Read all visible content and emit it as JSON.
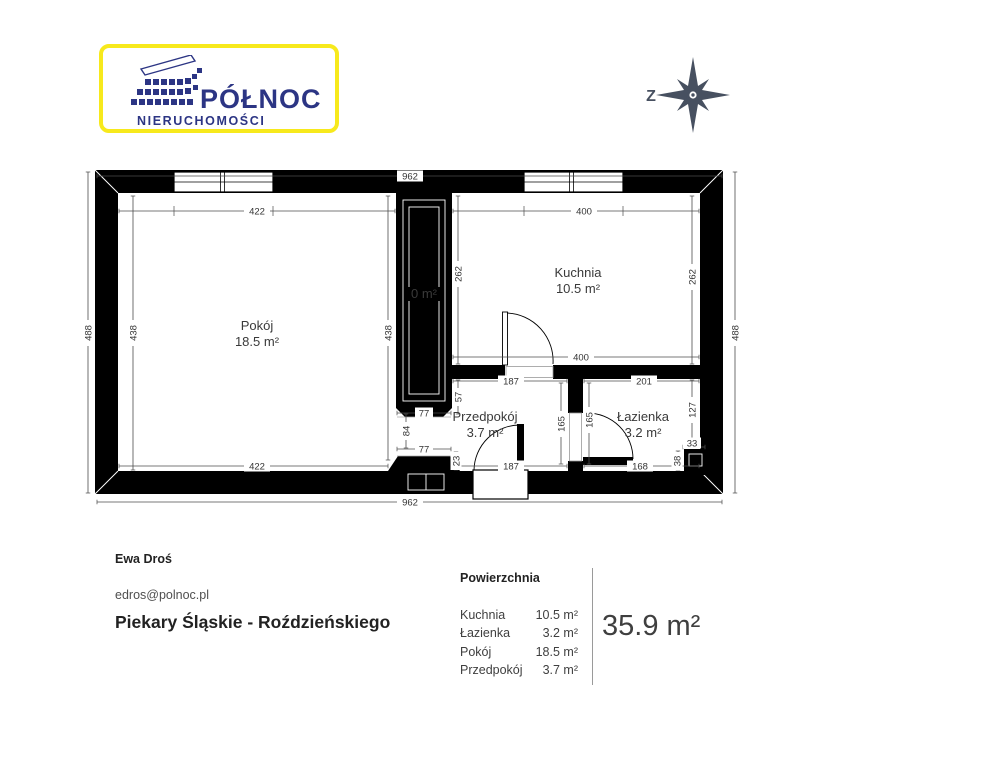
{
  "header": {
    "logo": {
      "line1": "PÓŁNOC",
      "line2": "NIERUCHOMOŚCI"
    },
    "compass": {
      "west_label": "Z"
    }
  },
  "plan": {
    "rooms": {
      "pokoj": {
        "name": "Pokój",
        "area": "18.5 m²"
      },
      "kuchnia": {
        "name": "Kuchnia",
        "area": "10.5 m²"
      },
      "przedpokoj": {
        "name": "Przedpokój",
        "area": "3.7 m²"
      },
      "lazienka": {
        "name": "Łazienka",
        "area": "3.2 m²"
      },
      "shaft": {
        "area": "0 m²"
      }
    },
    "dims": {
      "outer_top": "962",
      "outer_bottom": "962",
      "outer_left": "488",
      "outer_right": "488",
      "room_top": "422",
      "room_bottom": "422",
      "room_left": "438",
      "room_right": "438",
      "kitchen_top": "400",
      "kitchen_bottom": "400",
      "kitchen_left": "262",
      "kitchen_right": "262",
      "hall_top": "187",
      "hall_bottom": "187",
      "hall_right": "165",
      "bath_left": "165",
      "bath_top": "201",
      "bath_bottom": "168",
      "bath_right": "127",
      "shaft_below": "57",
      "pass_top": "77",
      "pass_bottom": "77",
      "pass_left": "84",
      "stub_right": "23",
      "corner_top": "33",
      "corner_left": "38"
    }
  },
  "footer": {
    "agent_name": "Ewa Droś",
    "agent_email": "edros@polnoc.pl",
    "location": "Piekary Śląskie - Roździeńskiego",
    "area_table": {
      "title": "Powierzchnia",
      "rows": [
        {
          "label": "Kuchnia",
          "value": "10.5 m²"
        },
        {
          "label": "Łazienka",
          "value": "3.2 m²"
        },
        {
          "label": "Pokój",
          "value": "18.5 m²"
        },
        {
          "label": "Przedpokój",
          "value": "3.7 m²"
        }
      ],
      "total": "35.9 m²"
    }
  }
}
